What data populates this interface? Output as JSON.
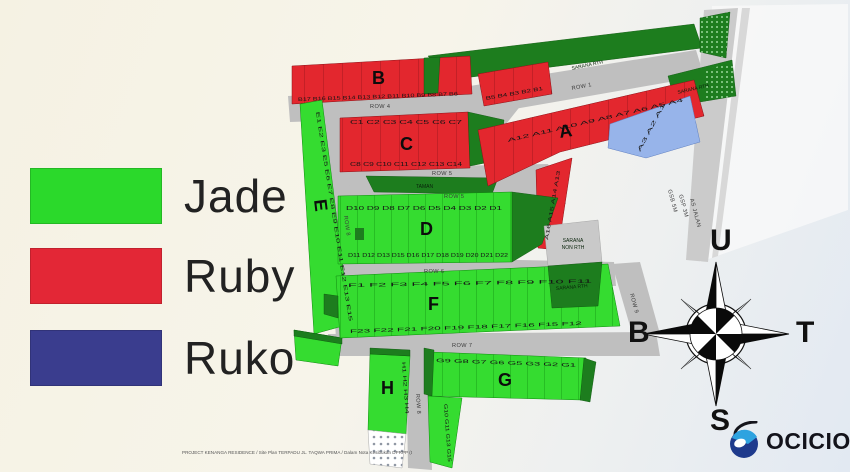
{
  "legend": {
    "items": [
      {
        "label": "Jade",
        "color": "#2bd92b"
      },
      {
        "label": "Ruby",
        "color": "#e32736"
      },
      {
        "label": "Ruko",
        "color": "#3a3d8e"
      }
    ]
  },
  "compass": {
    "north": "U",
    "east": "T",
    "south": "S",
    "west": "B"
  },
  "logo": {
    "text": "OCICIO"
  },
  "fine_print": "PROJECT KENANGA RESIDENCE / Site Plan TERPADU JL. TAQWA PRIMA / Dalam Nota Kesibukan DPRPP (Dudeg, 10/12/2019 102537)",
  "map": {
    "blocks": {
      "a": "A",
      "b": "B",
      "c": "C",
      "d": "D",
      "e": "E",
      "f": "F",
      "g": "G",
      "h": "H"
    },
    "roads": {
      "row1": "ROW 1",
      "row4": "ROW 4",
      "row5_upper": "ROW 5",
      "row5_lower": "ROW 5",
      "row6": "ROW 6",
      "row7": "ROW 7",
      "row8": "ROW 8",
      "row8b": "ROW 8",
      "row9": "ROW 9"
    },
    "areas": {
      "sarana_rth_top": "SARANA RTH",
      "sarana_rth_right": "SARANA RTH",
      "sarana_rth_mid": "SARANA RTH",
      "sarana_non_rth_line1": "SARANA",
      "sarana_non_rth_line2": "NON RTH",
      "taman": "TAMAN",
      "gsb": "GSB 5M",
      "gsp": "GSP 3M",
      "as_jalan": "AS JALAN"
    },
    "lots": {
      "b_row": [
        "B17",
        "B16",
        "B15",
        "B14",
        "B13",
        "B12",
        "B11",
        "B10",
        "B9",
        "B8",
        "B7",
        "B6"
      ],
      "b_right": [
        "B5",
        "B4",
        "B3",
        "B2",
        "B1"
      ],
      "a_top": [
        "A12",
        "A11",
        "A10",
        "A9",
        "A8",
        "A7",
        "A6",
        "A5",
        "A4"
      ],
      "a_side": [
        "A16",
        "A15",
        "A14",
        "A13"
      ],
      "a_blue": [
        "A3",
        "A2",
        "A1"
      ],
      "c_top": [
        "C1",
        "C2",
        "C3",
        "C4",
        "C5",
        "C6",
        "C7"
      ],
      "c_bottom": [
        "C8",
        "C9",
        "C10",
        "C11",
        "C12",
        "C13",
        "C14"
      ],
      "d_top": [
        "D10",
        "D9",
        "D8",
        "D7",
        "D6",
        "D5",
        "D4",
        "D3",
        "D2",
        "D1"
      ],
      "d_bottom": [
        "D11",
        "D12",
        "D13",
        "D15",
        "D16",
        "D17",
        "D18",
        "D19",
        "D20",
        "D21",
        "D22"
      ],
      "e_col": [
        "E1",
        "E2",
        "E3",
        "E5",
        "E6",
        "E7",
        "E8",
        "E9",
        "E10",
        "E11",
        "E12",
        "E13",
        "E15"
      ],
      "f_top": [
        "F1",
        "F2",
        "F3",
        "F4",
        "F5",
        "F6",
        "F7",
        "F8",
        "F9",
        "F10",
        "F11"
      ],
      "f_bottom": [
        "F23",
        "F22",
        "F21",
        "F20",
        "F19",
        "F18",
        "F17",
        "F16",
        "F15",
        "F12"
      ],
      "g_row": [
        "G9",
        "G8",
        "G7",
        "G6",
        "G5",
        "G3",
        "G2",
        "G1"
      ],
      "g_col": [
        "G10",
        "G11",
        "G13",
        "G15"
      ],
      "h_col": [
        "H1",
        "H2",
        "H3",
        "H4"
      ]
    }
  }
}
